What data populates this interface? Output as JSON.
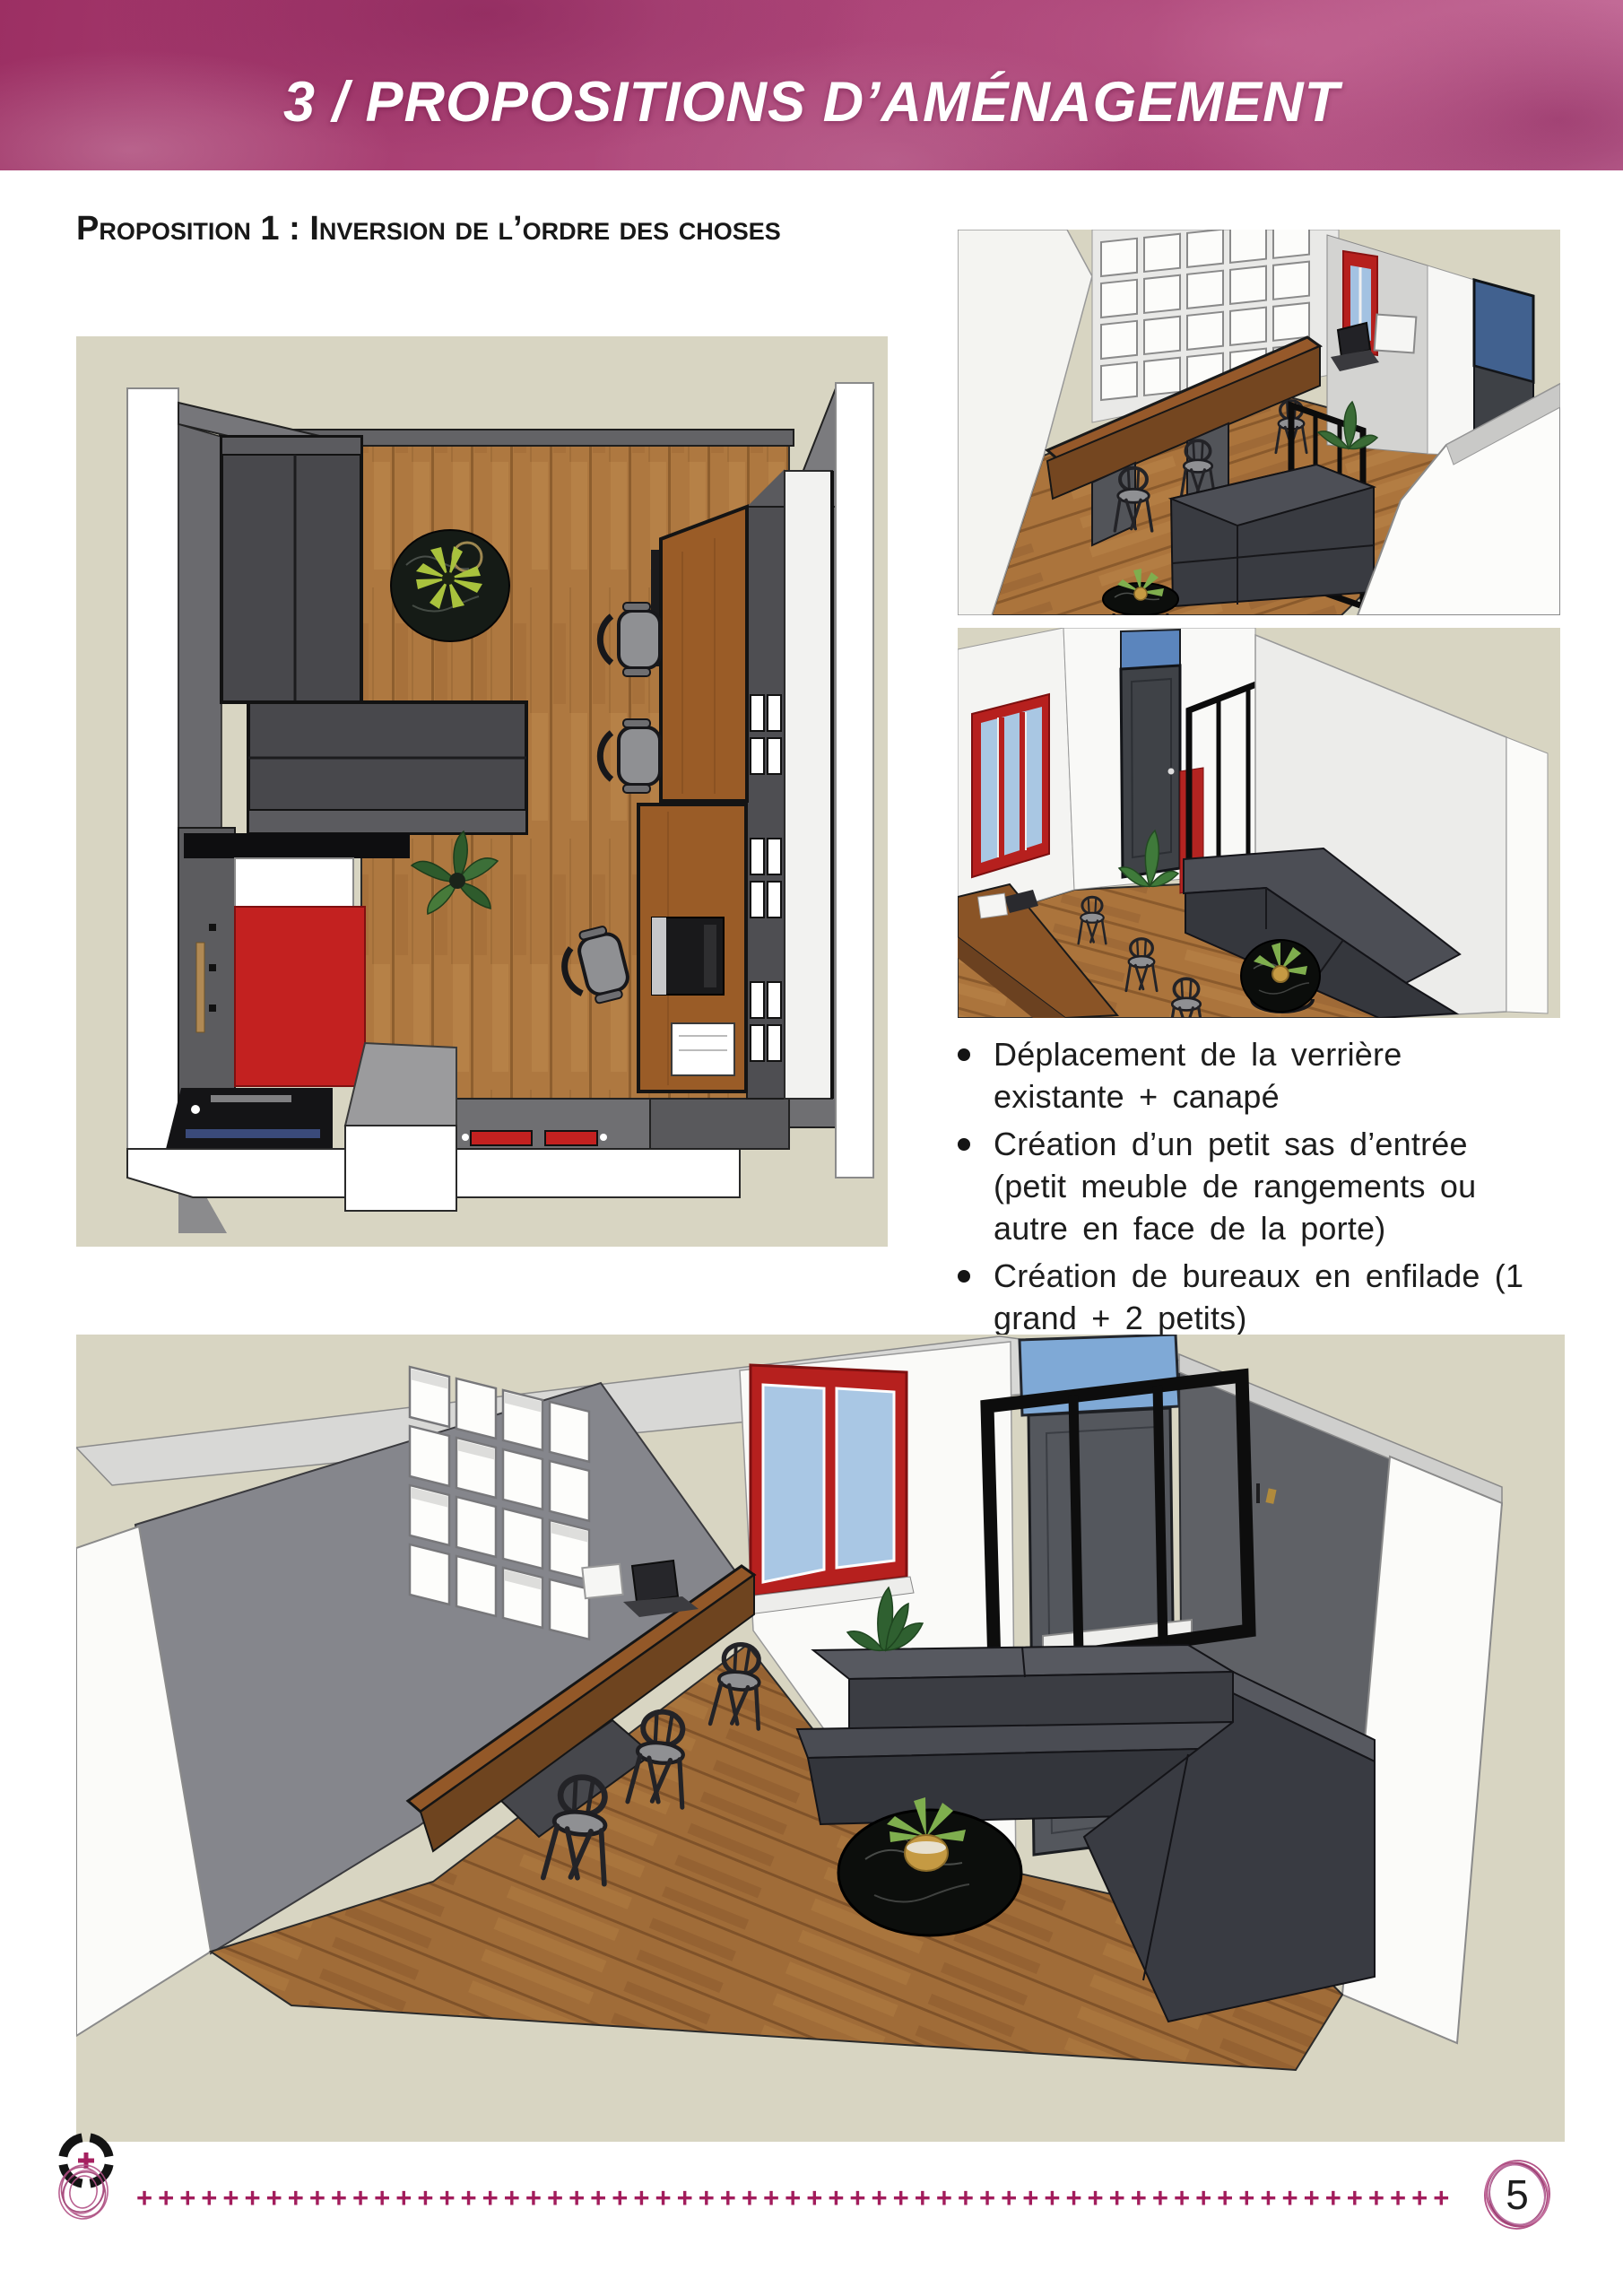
{
  "header": {
    "title": "3 / PROPOSITIONS D’AMÉNAGEMENT",
    "band_color": "#a63e72",
    "text_color": "#ffffff"
  },
  "section": {
    "heading": "Proposition 1 : Inversion de l’ordre des choses"
  },
  "bullets": {
    "items": [
      {
        "text": "Déplacement de la verrière\nexistante + canapé"
      },
      {
        "text": "Création d’un petit sas d’entrée\n(petit meuble de rangements ou\nautre en face de la porte)"
      },
      {
        "text": "Création de bureaux en enfilade (1\ngrand + 2 petits)"
      }
    ]
  },
  "figures": {
    "plan": {
      "alt": "plan-top-view-3d-render"
    },
    "persp1": {
      "alt": "perspective-3d-render-room-overview"
    },
    "persp2": {
      "alt": "perspective-3d-render-entrance-and-sofa"
    },
    "main": {
      "alt": "perspective-3d-render-full-room"
    }
  },
  "footer": {
    "plus_line": "+++++++++++++++++++++++++++++++++++++++++++++++++++++++++++++",
    "page_number": "5",
    "logo": "studio-logo"
  },
  "palette": {
    "band_magenta": "#a63e72",
    "plus_magenta": "#a21d5c",
    "render_background_beige": "#d8d5c2",
    "wood_brown": "#ad7740",
    "accent_red": "#c32120",
    "sofa_gray": "#45474d",
    "frame_black": "#0d0d0d",
    "glass_blue": "#a9c7e4"
  }
}
